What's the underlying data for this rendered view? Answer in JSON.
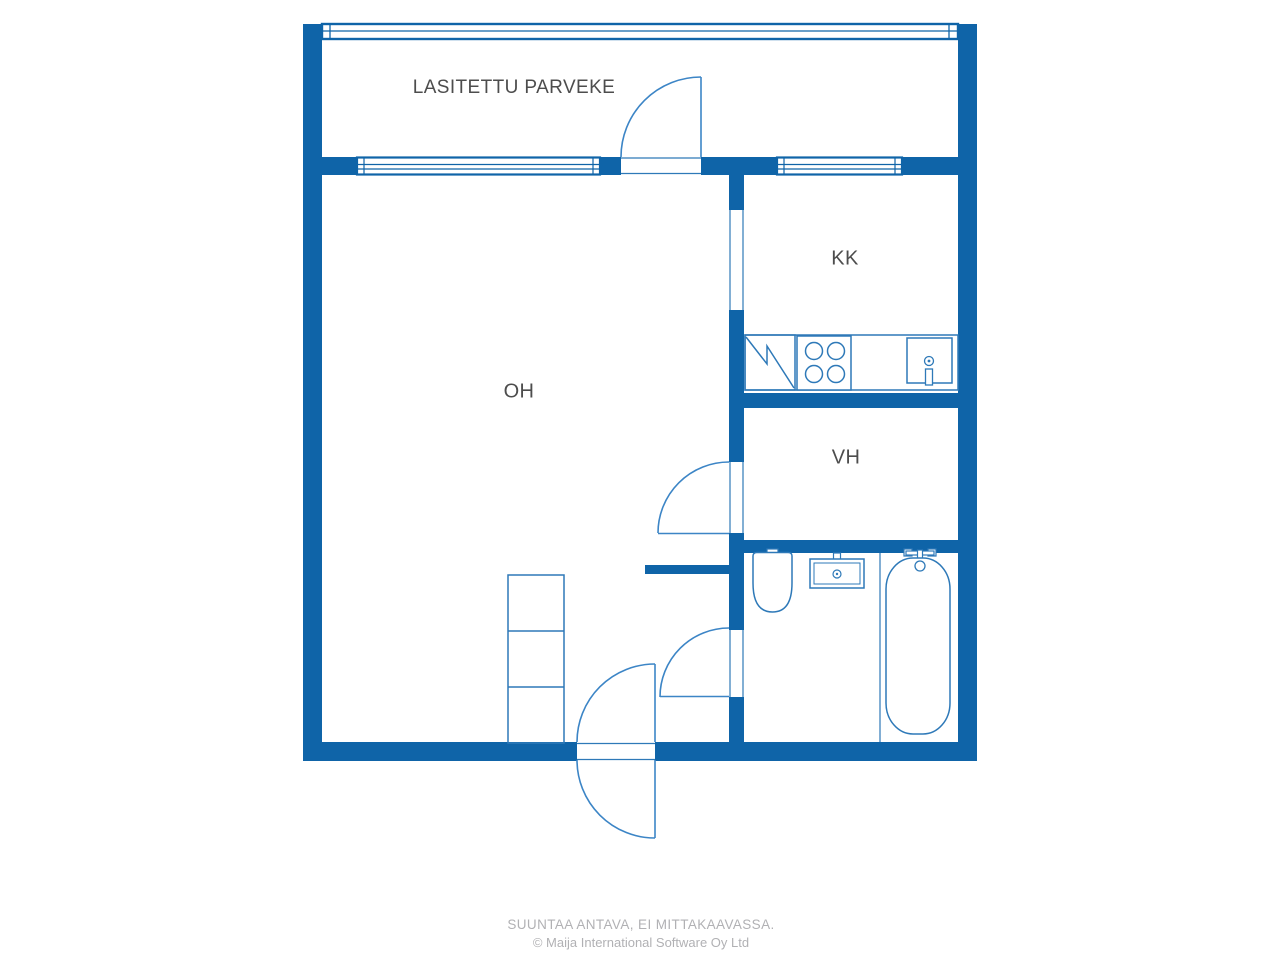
{
  "rooms": {
    "balcony": {
      "label": "LASITETTU PARVEKE"
    },
    "living_room": {
      "label": "OH"
    },
    "kitchenette": {
      "label": "KK"
    },
    "closet": {
      "label": "VH"
    }
  },
  "fixtures": {
    "kitchen": [
      "fridge-icon",
      "stove-icon",
      "sink-icon"
    ],
    "bathroom": [
      "toilet-icon",
      "washbasin-icon",
      "bathtub-icon"
    ],
    "living_room": [
      "wardrobe-icon"
    ]
  },
  "footer": {
    "disclaimer": "SUUNTAA ANTAVA, EI MITTAKAAVASSA.",
    "copyright": "© Maija International Software Oy Ltd"
  },
  "colors": {
    "wall_blue": "#0f64a8",
    "fixture_line_blue": "#2e79b8",
    "door_arc_blue": "#3c85c6",
    "room_label_gray": "#4d4d4d",
    "footer_gray": "#b1b1b4",
    "background": "#ffffff"
  }
}
